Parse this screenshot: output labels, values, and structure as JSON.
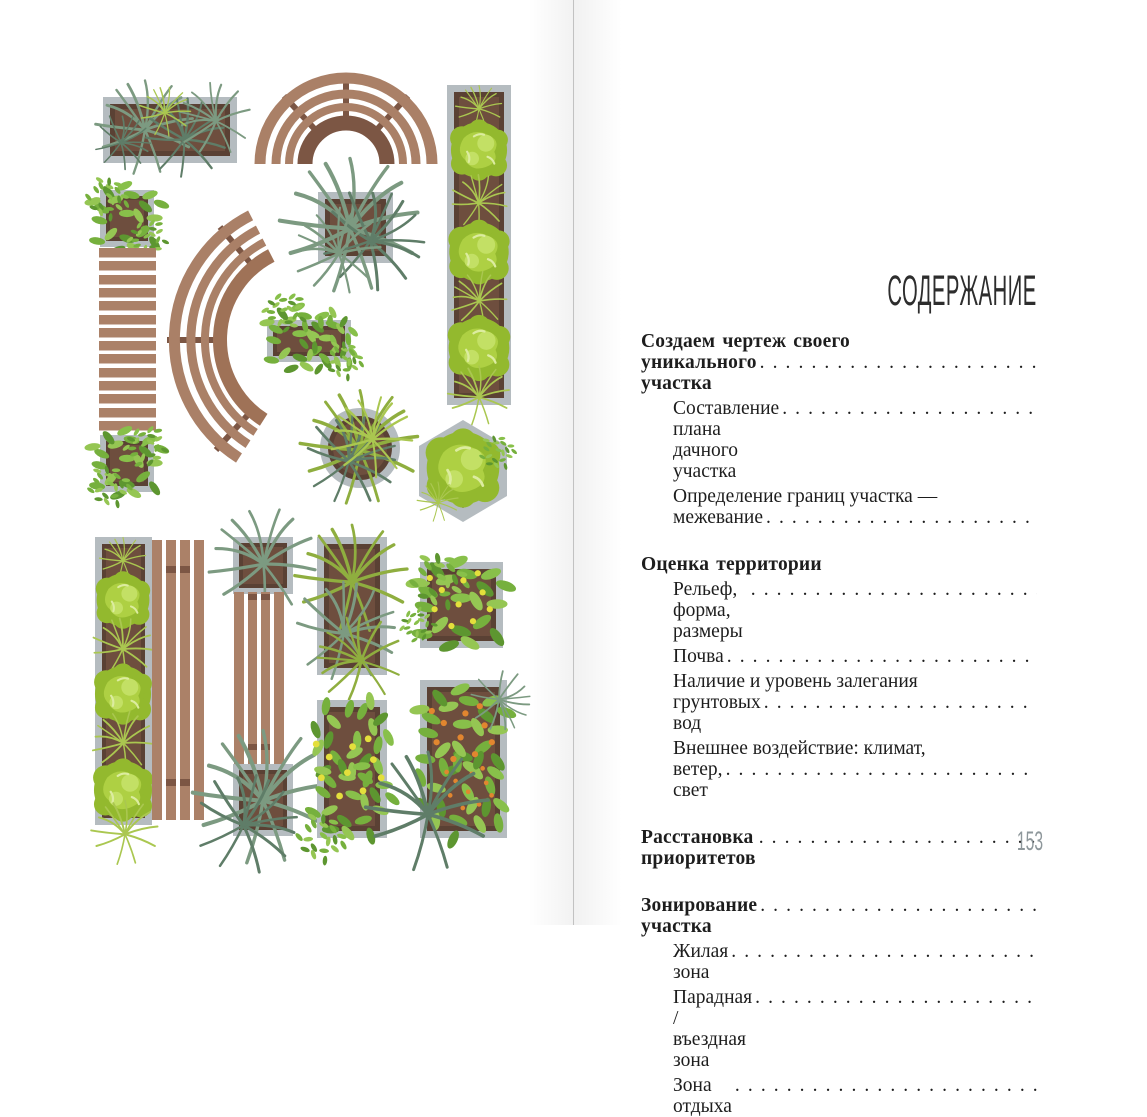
{
  "left": {
    "illustration": "garden-plan-top-view-elements",
    "elements": [
      "planter-grass-box",
      "arched-bench",
      "tall-planter-right",
      "leafy-planter-top",
      "wooden-plank-path",
      "leafy-planter-bottom",
      "curved-bench",
      "sage-grass-square-planter",
      "small-leafy-planter",
      "round-planter",
      "hexagonal-planter",
      "bush-planter-column",
      "vertical-plank-bench",
      "bench-with-end-planters",
      "grass-rect-planter",
      "flower-square-planter",
      "flower-rect-planter",
      "berry-rect-planter"
    ],
    "colors": {
      "wood": "#aa8067",
      "wood_dark": "#7c5644",
      "frame_gray": "#b5bcc0",
      "soil": "#6e4e3e",
      "soil_dark": "#5a4134",
      "bush_green": "#93b92e",
      "bush_light": "#aed043",
      "sage_green": "#7c9a81",
      "lime_green": "#aac750",
      "leaf_green": "#76b03d",
      "flower_yellow": "#e4df3c",
      "berry_orange": "#e2862f"
    }
  },
  "right": {
    "title": "СОДЕРЖАНИЕ",
    "page_number": "153",
    "toc": {
      "entries": [
        {
          "style": "section",
          "lines": [
            "Создаем чертеж своего",
            "уникального участка"
          ],
          "leader": true
        },
        {
          "style": "sub",
          "lines": [
            "Составление плана дачного участка"
          ],
          "leader": true
        },
        {
          "style": "sub",
          "lines": [
            "Определение границ участка —",
            "межевание"
          ],
          "leader": true
        },
        {
          "style": "section",
          "lines": [
            "Оценка территории"
          ],
          "leader": false
        },
        {
          "style": "sub",
          "lines": [
            "Рельеф, форма, размеры"
          ],
          "leader": true
        },
        {
          "style": "sub",
          "lines": [
            "Почва"
          ],
          "leader": true
        },
        {
          "style": "sub",
          "lines": [
            "Наличие и уровень залегания",
            "грунтовых вод"
          ],
          "leader": true
        },
        {
          "style": "sub",
          "lines": [
            "Внешнее воздействие: климат,",
            "ветер, свет"
          ],
          "leader": true
        },
        {
          "style": "section",
          "lines": [
            "Расстановка приоритетов"
          ],
          "leader": true
        },
        {
          "style": "section",
          "lines": [
            "Зонирование участка"
          ],
          "leader": true
        },
        {
          "style": "sub",
          "lines": [
            "Жилая зона"
          ],
          "leader": true
        },
        {
          "style": "sub",
          "lines": [
            "Парадная / въездная зона"
          ],
          "leader": true
        },
        {
          "style": "sub",
          "lines": [
            "Зона отдыха"
          ],
          "leader": true
        }
      ]
    }
  }
}
